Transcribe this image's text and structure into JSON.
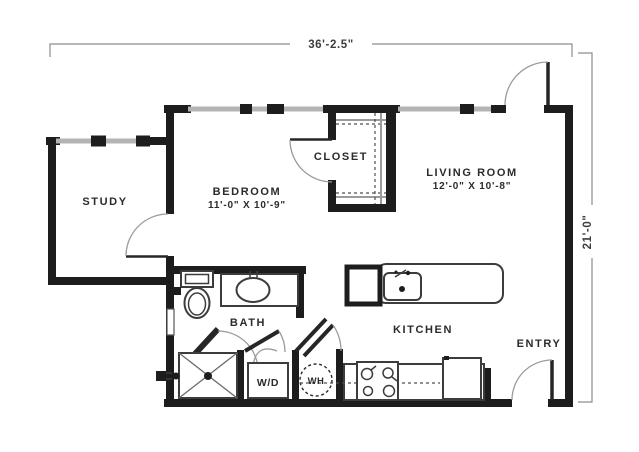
{
  "dimensions": {
    "overall_width": "36'-2.5\"",
    "overall_height": "21'-0\""
  },
  "rooms": {
    "study": {
      "name": "STUDY"
    },
    "bedroom": {
      "name": "BEDROOM",
      "size": "11'-0\" X 10'-9\""
    },
    "closet": {
      "name": "CLOSET"
    },
    "living_room": {
      "name": "LIVING ROOM",
      "size": "12'-0\" X 10'-8\""
    },
    "bath": {
      "name": "BATH"
    },
    "kitchen": {
      "name": "KITCHEN"
    },
    "entry": {
      "name": "ENTRY"
    },
    "laundry": {
      "name": "W/D"
    },
    "water_heater": {
      "name": "WH"
    }
  },
  "colors": {
    "wall": "#1d1d1d",
    "window_band": "#b4b4b4",
    "line": "#3c3c3c",
    "dim": "#8d8d8d",
    "text": "#2b2b2b",
    "bg": "#ffffff"
  }
}
